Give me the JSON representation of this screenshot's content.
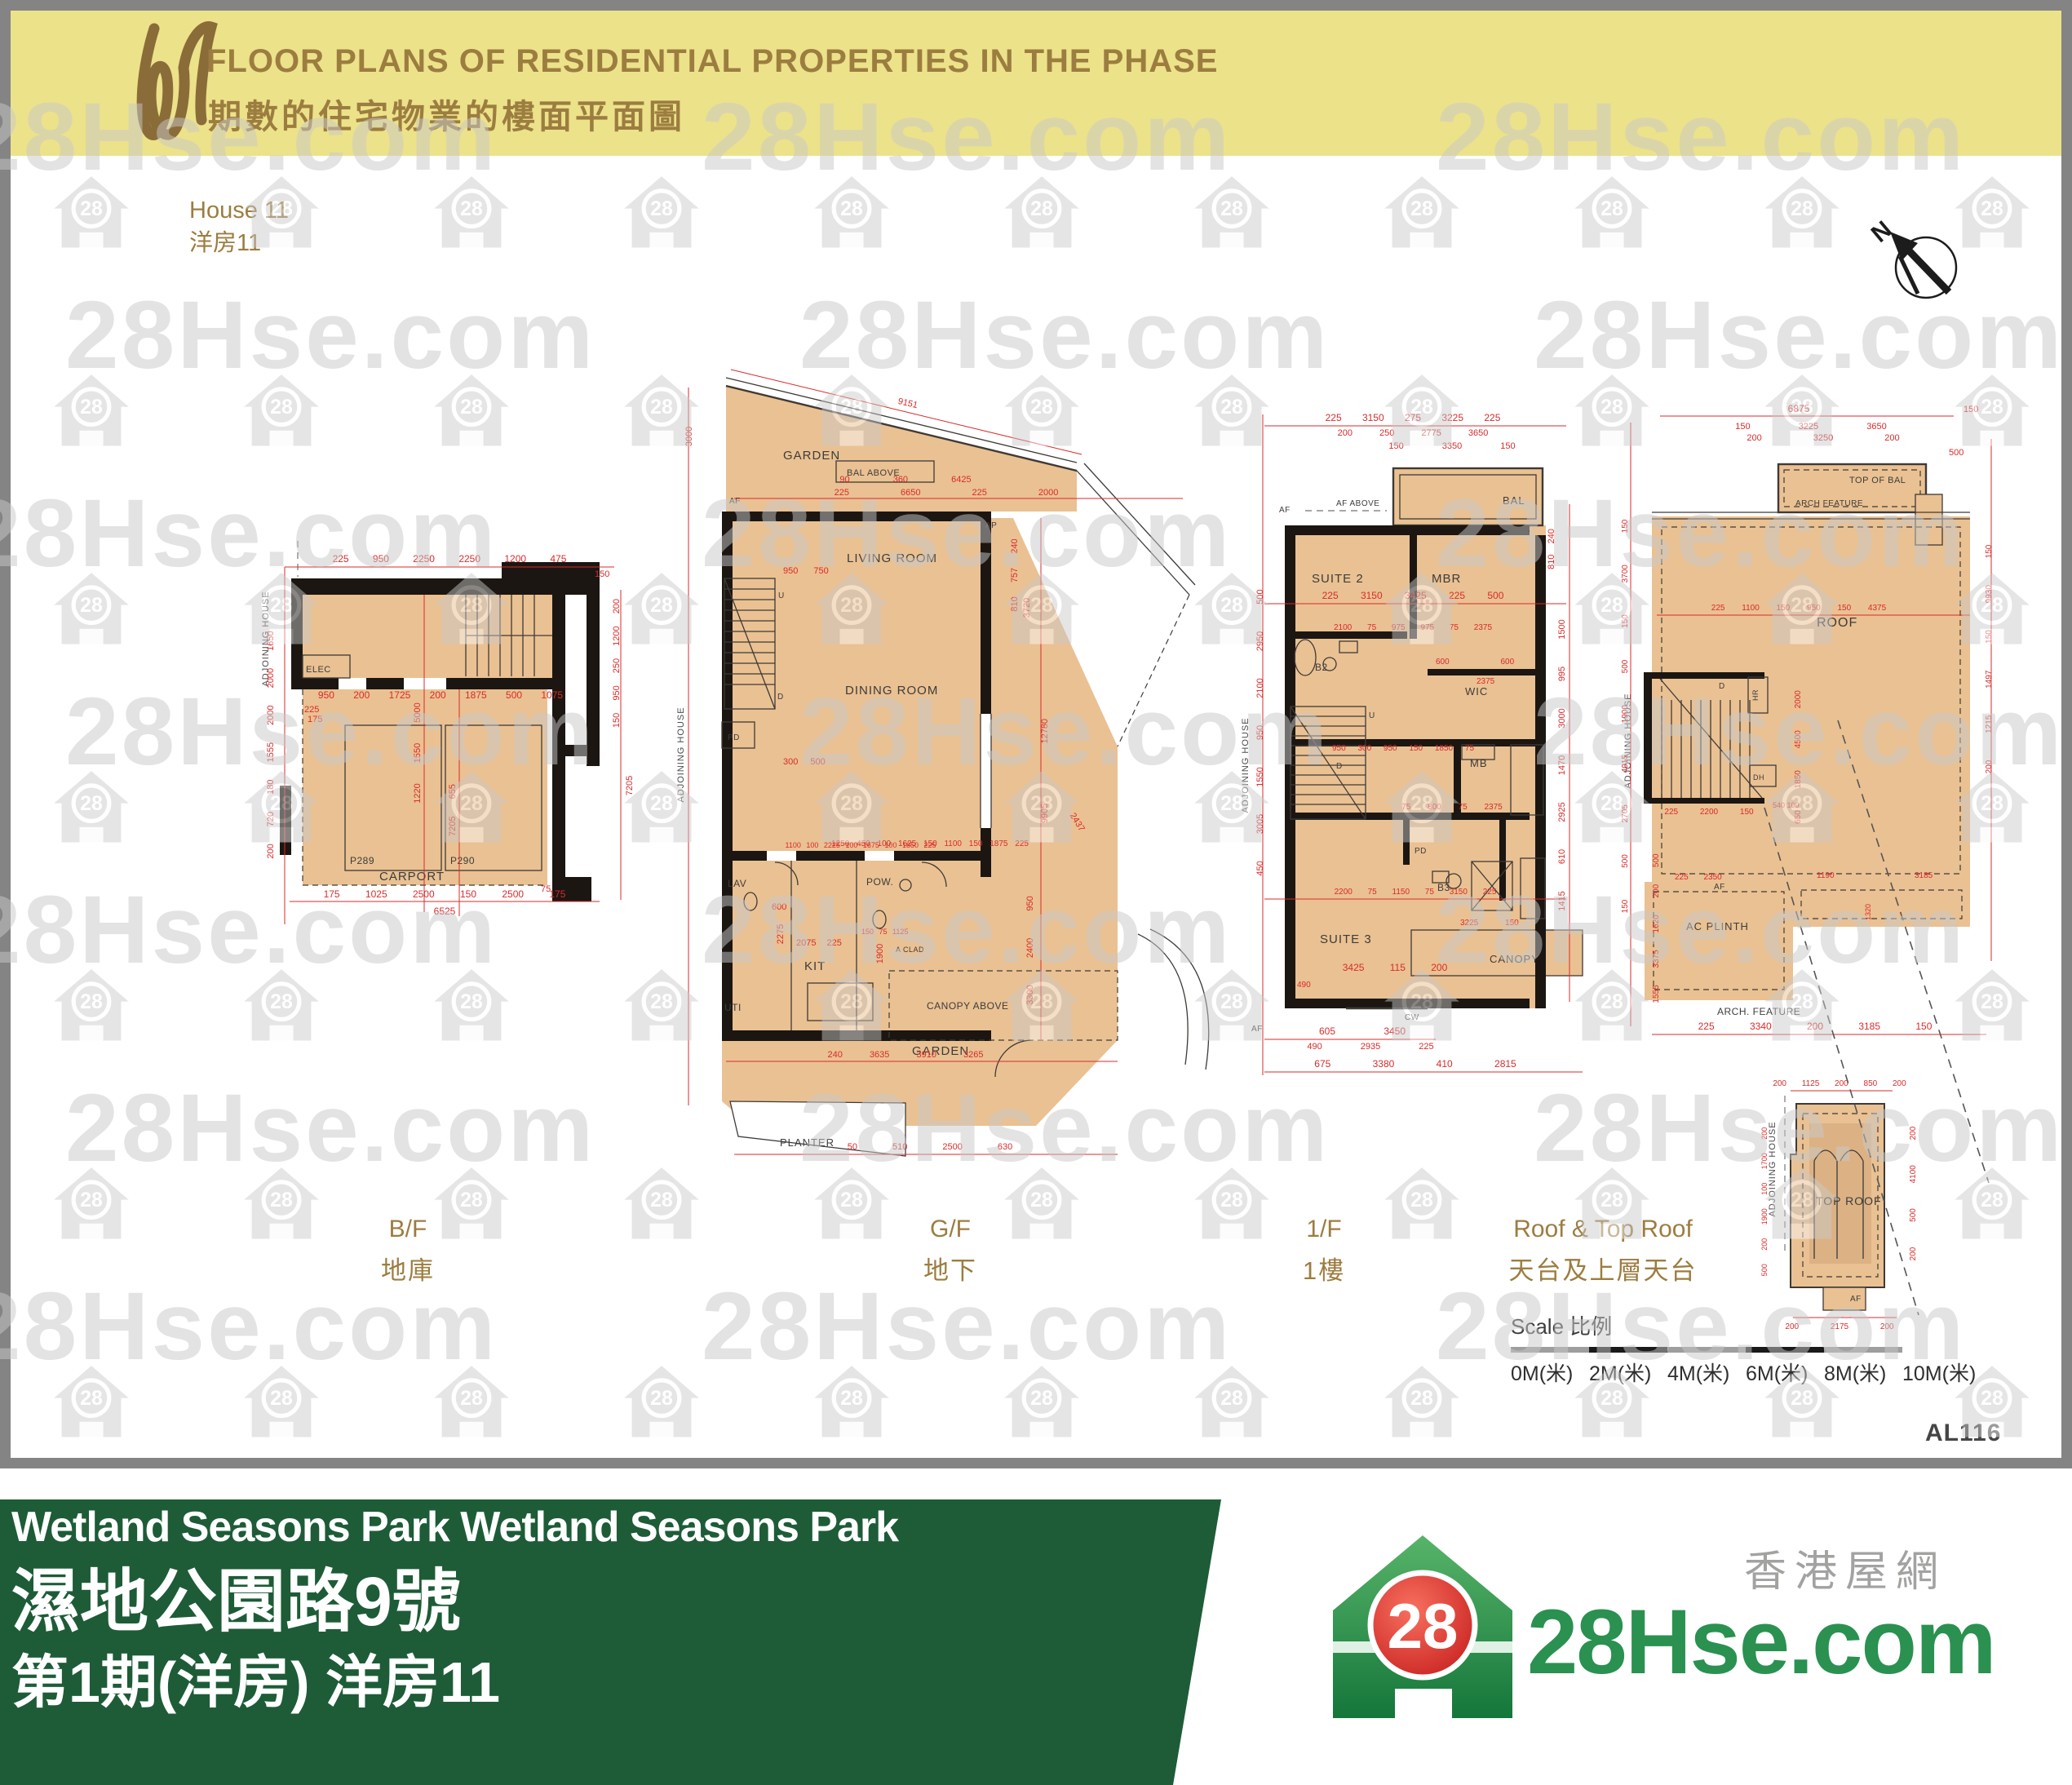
{
  "header": {
    "title_en": "FLOOR PLANS OF RESIDENTIAL PROPERTIES IN THE PHASE",
    "title_zh": "期數的住宅物業的樓面平面圖",
    "house_en": "House 11",
    "house_zh": "洋房11"
  },
  "compass": {
    "north": "N"
  },
  "watermark": {
    "text": "28Hse.com",
    "badge": "28"
  },
  "sheet_code": "AL116",
  "scale_bar": {
    "label": "Scale 比例",
    "ticks": [
      "0M(米)",
      "2M(米)",
      "4M(米)",
      "6M(米)",
      "8M(米)",
      "10M(米)"
    ]
  },
  "captions": {
    "bf_en": "B/F",
    "bf_zh": "地庫",
    "gf_en": "G/F",
    "gf_zh": "地下",
    "ff_en": "1/F",
    "ff_zh": "1樓",
    "roof_en": "Roof & Top Roof",
    "roof_zh": "天台及上層天台"
  },
  "plans": {
    "bf": {
      "adjoining": "ADJOINING HOUSE",
      "rooms": {
        "elec": "ELEC",
        "p289": "P289",
        "p290": "P290",
        "carport": "CARPORT"
      },
      "dims": {
        "top": "225 950 2250 2250 1200 475",
        "top2": "150",
        "mid": "950 200 1725 200 1875 500 1075",
        "mid2": "225",
        "bottom": "175 1025 2500 150 2500 175",
        "total": "6525",
        "b75": "75",
        "left": "200 720 180 1555 2000 2000 1650",
        "right": "150 950 250 1200 200",
        "right2": "7205",
        "inner_v": "1220 1550 5000",
        "inner_v2": "7205 655",
        "inner_h": "175"
      }
    },
    "gf": {
      "adjoining": "ADJOINING HOUSE",
      "rooms": {
        "garden_top": "GARDEN",
        "bal_above": "BAL ABOVE",
        "af": "AF",
        "ap": "AP",
        "living": "LIVING ROOM",
        "dining": "DINING ROOM",
        "u": "U",
        "d": "D",
        "pd": "PD",
        "lav": "LAV",
        "pow": "POW.",
        "kit": "KIT",
        "uti": "UTI",
        "a_clad": "A CLAD",
        "canopy_above": "CANOPY ABOVE",
        "garden_bottom": "GARDEN",
        "planter": "PLANTER"
      },
      "dims": {
        "slant": "9151",
        "left_v": "3000",
        "row1": "90 360 6425",
        "row2": "225 6650 225 2000",
        "right_v1": "810 757 240",
        "right_v2": "3720",
        "right_v3": "9905 12780",
        "right_v4": "3300 2400 950",
        "svc": "1250 450 100 1625 150 1100 150 1875 225",
        "kit_w": "2275",
        "kit_w2": "2075 225",
        "kit_w3": "150 75 1125",
        "v1900": "1900",
        "grow": "240 3635 3910 3265",
        "brow": "50 510 2500 630",
        "diag": "2437",
        "d600": "600",
        "inner1": "950 750",
        "inner2": "300 500",
        "inner3": "1100 100 2225 100 1675 100 1850 225"
      }
    },
    "ff": {
      "adjoining": "ADJOINING HOUSE",
      "rooms": {
        "af_above": "AF ABOVE",
        "af": "AF",
        "af2": "AF",
        "bal": "BAL",
        "suite2": "SUITE 2",
        "mbr": "MBR",
        "b2": "B2",
        "wic": "WIC",
        "mb": "MB",
        "u": "U",
        "d": "D",
        "pd": "PD",
        "b3": "B3",
        "suite3": "SUITE 3",
        "canopy": "CANOPY",
        "cw": "CW"
      },
      "dims": {
        "top1": "225 3150 275 3225 225",
        "top2": "200 250 2775 3650",
        "top3": "150 3350 150",
        "row1": "225 3150 3425 225 500",
        "row2": "2100 75 975 975 75 2375",
        "w600": "600 600",
        "w2375": "2375",
        "row4": "950 300 950 150 1850 75",
        "row5": "75 800 75 2375",
        "row6": "2200 75 1150 75 3150 225",
        "c3225": "3225 150",
        "row7": "3425 115 200",
        "b490": "490",
        "row8": "605 3450",
        "row9": "490 2935 225",
        "row10": "675 3380 410 2815",
        "left_v": "450 3005 1550 950 2100 2950 500",
        "right_v": "1415 610 2925 1470 3000 995 1500",
        "right_v2": "810 240"
      }
    },
    "roof": {
      "adjoining": "ADJOINING HOUSE",
      "labels": {
        "top_of_bal": "TOP OF BAL",
        "arch_feature": "ARCH FEATURE",
        "roof": "ROOF",
        "d": "D",
        "hr": "HR",
        "dh": "DH",
        "ac_plinth": "AC PLINTH",
        "arch_feature2": "ARCH. FEATURE",
        "af": "AF"
      },
      "dims": {
        "top1": "6875",
        "t150": "150",
        "top2": "150 3225 3650",
        "top3": "200 3250 200",
        "t500": "500",
        "row1": "225 1100 150 950 150 4375",
        "left_v": "150 500 2705 4015 1900 500 150 3700 150",
        "left_v2": "1555 3375 1620 200 500",
        "right_v": "200 1215 1497 150 9930 150",
        "inner_v": "650 1850 4500 2000",
        "srow": "225 2200 150",
        "srow2": "540 100",
        "acrow": "225 2350",
        "acr2": "1190",
        "acr3": "3185",
        "acr4": "1320",
        "bottom": "225 3340 200 3185 150"
      }
    },
    "top_roof": {
      "adjoining": "ADJOINING HOUSE",
      "label": "TOP ROOF",
      "af": "AF",
      "dims": {
        "top": "200 1125 200 850 200",
        "left_v": "500 200 1900 100 1700 200",
        "right_v": "200 500 4100 200",
        "bottom": "200 2175 200"
      }
    }
  },
  "footer": {
    "line1": "Wetland Seasons Park Wetland Seasons Park",
    "line2": "濕地公園路9號",
    "line3": "第1期(洋房) 洋房11",
    "brand_site": "28Hse.com",
    "brand_zh": "香港屋網",
    "brand_badge": "28"
  },
  "colors": {
    "header_bg": "#ece28a",
    "brown": "#9c7d40",
    "tan": "#eac192",
    "wall": "#1b1612",
    "dim_red": "#d92b2b",
    "footer_green": "#1d5c37",
    "brand_green": "#2a9150",
    "brand_red": "#d42a26",
    "watermark_gray": "#c9c9c9",
    "frame_gray": "#848484"
  }
}
